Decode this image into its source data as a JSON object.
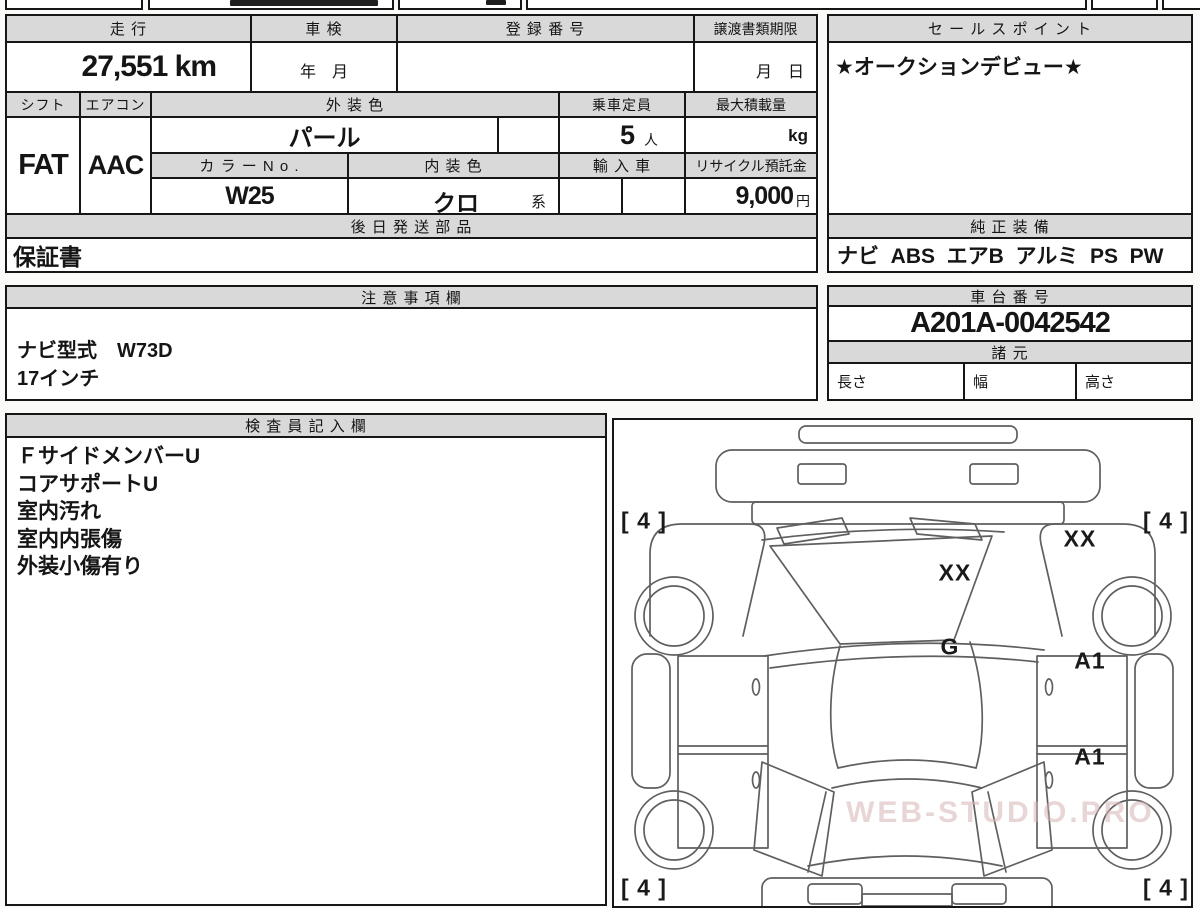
{
  "top_table": {
    "mileage_label": "走 行",
    "mileage_value": "27,551 km",
    "shaken_label": "車 検",
    "shaken_value": "年　月",
    "registration_label": "登 録 番 号",
    "registration_value": "",
    "transfer_docs_label": "譲渡書類期限",
    "transfer_docs_value": "月　日",
    "shift_label": "シフト",
    "shift_value": "FAT",
    "aircon_label": "エアコン",
    "aircon_value": "AAC",
    "exterior_color_label": "外 装 色",
    "exterior_color_value": "パール",
    "capacity_label": "乗車定員",
    "capacity_value": "5",
    "capacity_unit": "人",
    "max_load_label": "最大積載量",
    "max_load_unit": "kg",
    "color_no_label": "カ ラ ー N o .",
    "color_no_value": "W25",
    "interior_color_label": "内 装 色",
    "interior_color_value": "クロ",
    "interior_color_suffix": "系",
    "import_label": "輸 入 車",
    "recycle_label": "リサイクル預託金",
    "recycle_value": "9,000",
    "recycle_unit": "円",
    "later_parts_label": "後 日 発 送 部 品",
    "later_parts_value": "保証書"
  },
  "sales_point": {
    "label": "セ ー ル ス ポ イ ン ト",
    "value": "★オークションデビュー★"
  },
  "equipment": {
    "label": "純 正 装 備",
    "value": "ナビ  ABS  エアB  アルミ  PS  PW"
  },
  "remarks": {
    "label": "注 意 事 項 欄",
    "lines": [
      "ナビ型式　W73D",
      "17インチ"
    ]
  },
  "chassis": {
    "label": "車 台 番 号",
    "value": "A201A-0042542"
  },
  "specs": {
    "label": "諸 元",
    "length_label": "長さ",
    "width_label": "幅",
    "height_label": "高さ"
  },
  "inspector": {
    "label": "検 査 員 記 入 欄",
    "lines": [
      "ＦサイドメンバーU",
      "コアサポートU",
      "室内汚れ",
      "室内内張傷",
      "外装小傷有り"
    ]
  },
  "diagram": {
    "marks": [
      {
        "label": "[ 4 ]",
        "x": 30,
        "y": 101
      },
      {
        "label": "[ 4 ]",
        "x": 552,
        "y": 101
      },
      {
        "label": "XX",
        "x": 466,
        "y": 119
      },
      {
        "label": "XX",
        "x": 341,
        "y": 153
      },
      {
        "label": "G",
        "x": 336,
        "y": 227
      },
      {
        "label": "A1",
        "x": 476,
        "y": 241
      },
      {
        "label": "A1",
        "x": 476,
        "y": 337
      },
      {
        "label": "[ 4 ]",
        "x": 30,
        "y": 468
      },
      {
        "label": "[ 4 ]",
        "x": 552,
        "y": 468
      }
    ],
    "watermark": "WEB-STUDIO.PRO"
  },
  "colors": {
    "header_bg": "#d9d9d9",
    "border": "#161616",
    "diagram_line": "#5f5f5f"
  }
}
